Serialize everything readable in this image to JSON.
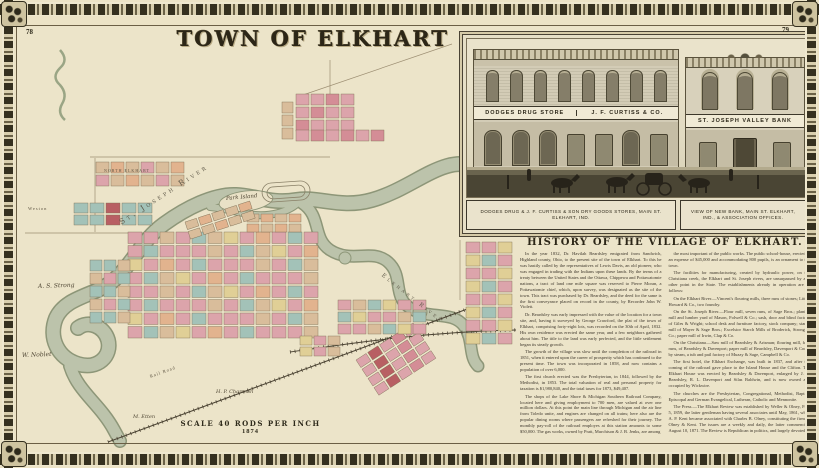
{
  "page": {
    "left_number": "78",
    "right_number": "79",
    "title": "TOWN OF ELKHART"
  },
  "map": {
    "scale_line1": "SCALE 40 RODS PER INCH",
    "scale_line2": "1874",
    "labels": [
      {
        "text": "St. Joseph River",
        "x": 120,
        "y": 218,
        "rot": -33,
        "cls": "river",
        "size": 7.5
      },
      {
        "text": "Park Island",
        "x": 226,
        "y": 196,
        "rot": -5,
        "cls": "script",
        "size": 5.5
      },
      {
        "text": "Elkhart River",
        "x": 382,
        "y": 272,
        "rot": 38,
        "cls": "river",
        "size": 5.5
      },
      {
        "text": "A. S. Strong",
        "x": 38,
        "y": 283,
        "rot": -2,
        "cls": "script",
        "size": 6
      },
      {
        "text": "W. Noblet",
        "x": 22,
        "y": 352,
        "rot": -2,
        "cls": "script",
        "size": 6
      },
      {
        "text": "M. Etten",
        "x": 133,
        "y": 414,
        "rot": 0,
        "cls": "script",
        "size": 5
      },
      {
        "text": "H. P. Chapman",
        "x": 216,
        "y": 389,
        "rot": 0,
        "cls": "script",
        "size": 5
      },
      {
        "text": "Rail Road",
        "x": 150,
        "y": 374,
        "rot": -20,
        "cls": "tiny",
        "size": 4.5
      },
      {
        "text": "Weston",
        "x": 28,
        "y": 206,
        "rot": 0,
        "cls": "tiny",
        "size": 4.5
      },
      {
        "text": "NORTH ELKHART",
        "x": 104,
        "y": 168,
        "rot": 0,
        "cls": "tiny",
        "size": 4
      }
    ]
  },
  "inset": {
    "signs": {
      "left_sign": "DODGES DRUG STORE",
      "mid_sign": "J. F. CURTISS & CO.",
      "bank_sign": "ST. JOSEPH VALLEY BANK"
    },
    "captions": {
      "left": "DODGES DRUG & J. F. CURTISS & SON DRY GOODS STORES, MAIN ST. ELKHART, IND.",
      "right": "VIEW OF NEW BANK, MAIN ST. ELKHART, IND., & ASSOCIATION OFFICES."
    }
  },
  "history": {
    "heading": "HISTORY OF THE VILLAGE OF ELKHART.",
    "paragraphs": [
      "In the year 1832, Dr. Havilah Beardsley emigrated from Sandwich, Highland county, Ohio, to the present site of the town of Elkhart. To this he was hastily called by the representatives of Lewis Davis, an old pioneer, who was engaged in trading with the Indians upon these lands. By the terms of a treaty between the United States and the Ottawa, Chippewa and Pottawatomie nations, a tract of land one mile square was reserved to Pierre Moran, a Pottawatomie chief, which, upon survey, was designated as the site of the town. This tract was purchased by Dr. Beardsley, and the deed for the same is the first conveyance placed on record in the county, by Recorder John W. Violett.",
      "Dr. Beardsley was early impressed with the value of the location for a town site, and, having it surveyed by George Crawford, the plat of the town of Elkhart, comprising forty-eight lots, was recorded on the 30th of April, 1832. His own residence was erected the same year, and a few neighbors gathered about him. The title to the land was early perfected, and the little settlement began its steady growth.",
      "The growth of the village was slow until the completion of the railroad in 1851, when it entered upon the career of prosperity which has continued to the present time. The town was incorporated in 1858, and now contains a population of over 6,000.",
      "The first church erected was the Presbyterian, in 1844, followed by the Methodist, in 1853. The total valuation of real and personal property for taxation is $1,980,840, and the total taxes for 1873, $49,407.",
      "The shops of the Lake Shore & Michigan Southern Railroad Company, located here and giving employment to 700 men, are valued at over one million dollars. At this point the main line through Michigan and the air line from Toledo unite, and engines are changed on all trains; here also are the popular dining rooms where passengers are refreshed for their journey. The monthly pay-roll of the railroad employes at this station amounts to some $50,000. The gas works, owned by Pratt, Murchison & J. B. Jenks, are among",
      "the most important of the public works. The public school-house, erected at an expense of $45,000 and accommodating 800 pupils, is an ornament to the town.",
      "The facilities for manufacturing, created by hydraulic power, on the Christiana creek, the Elkhart and St. Joseph rivers, are unsurpassed by any other point in the State. The establishments already in operation are as follows:",
      "On the Elkhart River.—Vincent's flouring mills, three runs of stones; Little, Howard & Co., two foundry.",
      "On the St. Joseph River.—Flour mill, seven runs, of Sage Bros.; planing mill and lumber yard of Mason, Folwell & Co.; sash, door and blind factory of Giles & Wright; school desk and furniture factory, stock company; starch mill of Mayer & Sage Bros.; Excelsior Starch Mills of Broderick, Strong & Co.; paper mill of Irwin, Clap & Co.",
      "On the Christiana.—Saw mill of Beardsley & Arisman; flouring mill, four runs, of Beardsley & Davenport; paper mill of Beardsley, Davenport & Cook; by steam, a tub and pail factory of Muzzy & Sage, Campbell & Co.",
      "The first hotel, the Elkhart Exchange, was built in 1837, and after the coming of the railroad gave place to the Island House and the Clifton. The Elkhart House was erected by Beardsley & Davenport, enlarged by J. R. Beardsley, R. L. Davenport and Silas Baldwin, and is now owned and occupied by Wickwire.",
      "The churches are the Presbyterian, Congregational, Methodist, Baptist, Episcopal and German Evangelical, Lutheran, Catholic and Mennonite.",
      "The Press.—The Elkhart Review was established by Weller & Olney, Feb. 5, 1859, the latter gentleman having several associates until May, 1861, when A. P. Kent became associated with Charles B. Olney, constituting the firm of Olney & Kent. The issues are a weekly and daily, the latter commencing August 10, 1871. The Review is Republican in politics, and largely devoted to local news and interests. The Observer was established in 1872, by Edward Molloy, the editors being Edward and Emma Molloy, to whom was added, in 1873, B. K. Brooks, Esq. Devoted largely to local news; in politics, Republican. The Democrat Union was first issued November 12, 1872, by W. Sweet, editor and proprietor; revived October, 1873, by Spencer & Bro., and finally published by J. P. Ford & Bro., monthly, is the organ of the Mennonite church, and is widely patronized. It is printed both in English and German.",
      "Business Houses.—The business houses, in addition to the manufactories already named, number over 150, and are of every variety usual in a town of this importance. Many of the business buildings are of the first class in structure and architectural appearance.",
      "The professions of law and medicine are well represented. Two Masonic lodges, a Chapter, and Odd Fellows lodge are in a prosperous condition. Besides the Opera House is also a very creditable institution.",
      "We conclude this notice with the remark that the town is not only one of the most prosperous in northern Indiana, but it is destined to rank in wealth and population among the first in the State."
    ]
  }
}
